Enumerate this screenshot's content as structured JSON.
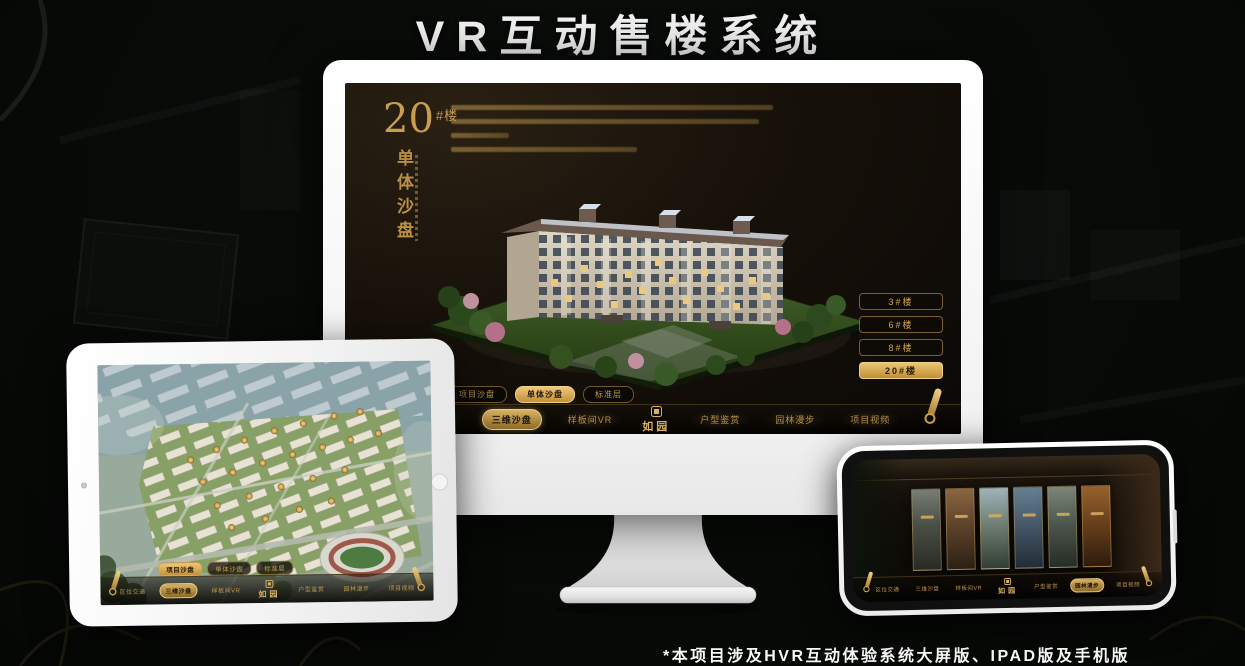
{
  "header": {
    "title": "VR互动售楼系统"
  },
  "footer": {
    "note": "*本项目涉及HVR互动体验系统大屏版、IPAD版及手机版"
  },
  "colors": {
    "gold": "#c9a254",
    "gold_bright": "#eac672",
    "screen_bg": "#17110a",
    "frame_white": "#f4f4f4"
  },
  "nav": {
    "logo": "如园",
    "items": [
      "区位交通",
      "三维沙盘",
      "样板间VR",
      "户型鉴赏",
      "园林漫步",
      "项目视频"
    ]
  },
  "sub_tabs": [
    "项目沙盘",
    "单体沙盘",
    "标准层"
  ],
  "desktop": {
    "block_title_num": "20",
    "block_title_suffix": "#楼",
    "block_subtitle": "单体沙盘",
    "floor_buttons": [
      "3#楼",
      "6#楼",
      "8#楼",
      "20#楼"
    ],
    "active_floor": "20#楼",
    "active_sub_tab": "单体沙盘",
    "active_nav": "三维沙盘"
  },
  "tablet": {
    "active_sub_tab": "项目沙盘",
    "active_nav": "三维沙盘"
  },
  "phone": {
    "active_nav": "园林漫步",
    "gallery_card_count": 6
  }
}
